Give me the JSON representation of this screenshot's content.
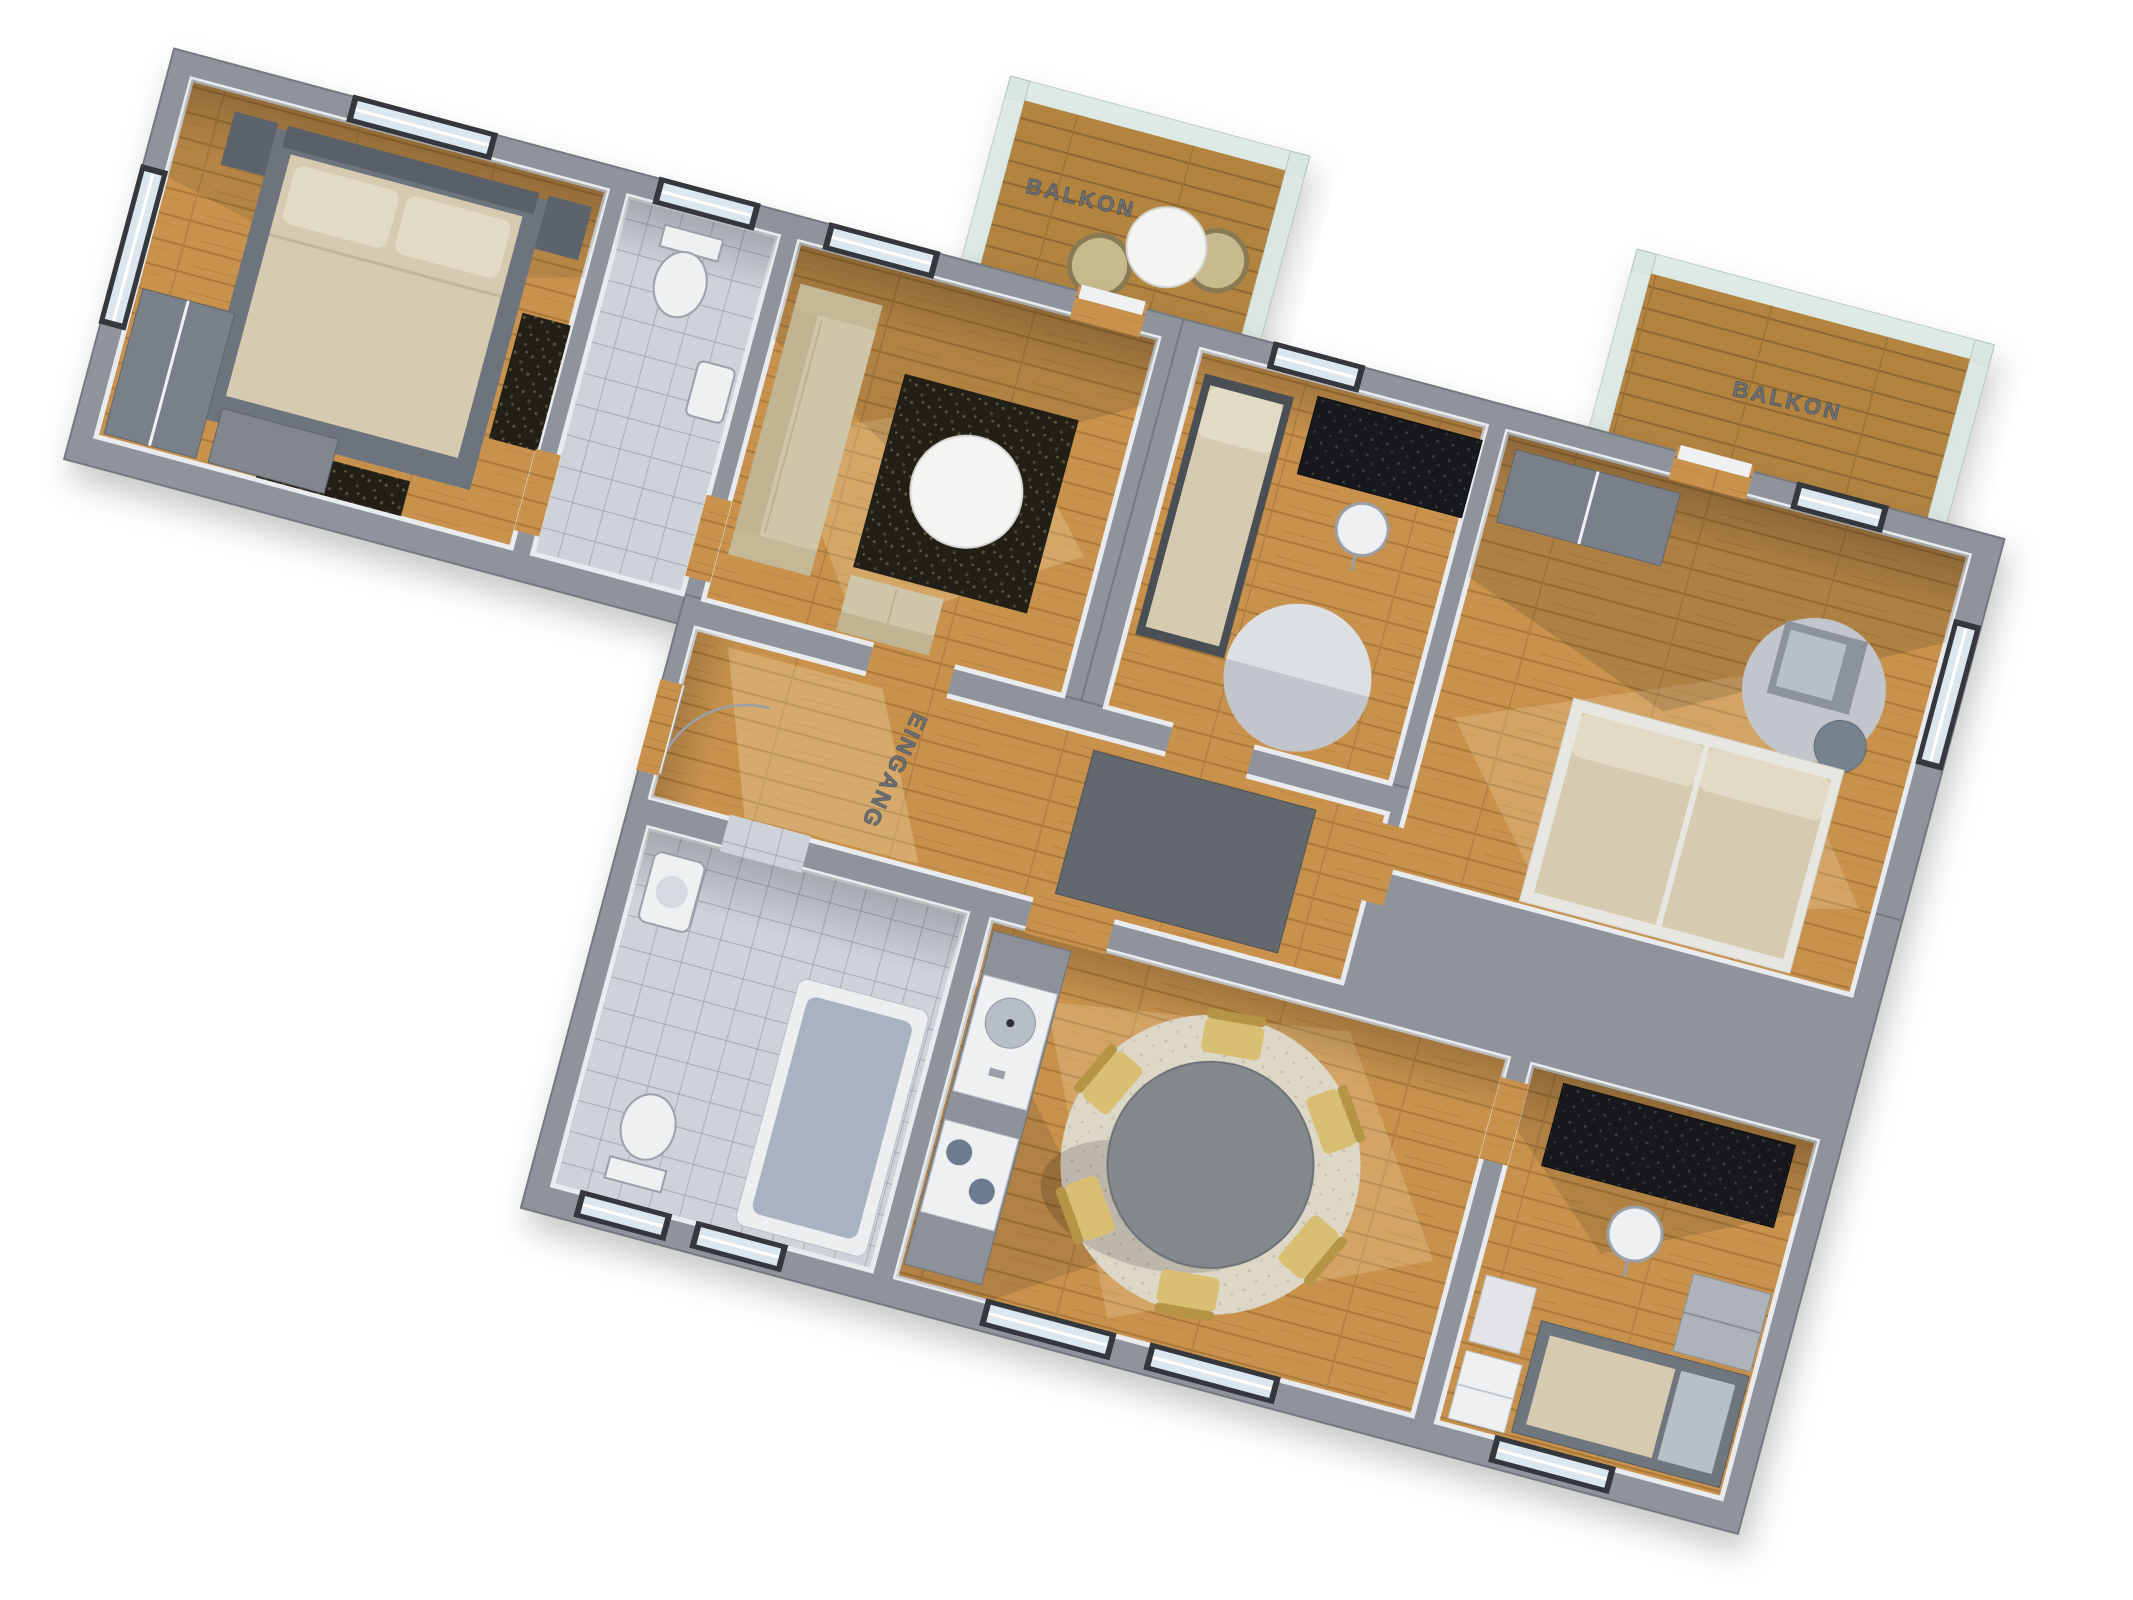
{
  "scene": {
    "background": "#ffffff",
    "labels": {
      "balcony_top": "BALKON",
      "balcony_right": "BALKON",
      "entrance": "EINGANG"
    },
    "palette": {
      "wall": "#8f949c",
      "wall_edge": "#75797f",
      "wood": "#c8924d",
      "wood_balcony": "#b28441",
      "tile": "#ced2d9",
      "rug_dark": "#221f17",
      "rug_beige": "#ded8ca",
      "rug_gray": "#c2c6cc",
      "sofa": "#cfc5a8",
      "mattress": "#d6cbb0",
      "pillow": "#e2dac4",
      "table_white": "#f4f4f2",
      "dining_table": "#84888c",
      "chair_gold": "#d9bf72",
      "chair_gold_back": "#b59545",
      "desk_dark": "#17181c",
      "glass": "#d7e6e1",
      "mat_gray": "#63686f",
      "fixture_white": "#eef0f2",
      "tub_inner": "#a8b2c2",
      "bed_frame_gray": "#6e747d",
      "wardrobe_gray": "#7a8089",
      "label_color": "#6c7178"
    }
  }
}
